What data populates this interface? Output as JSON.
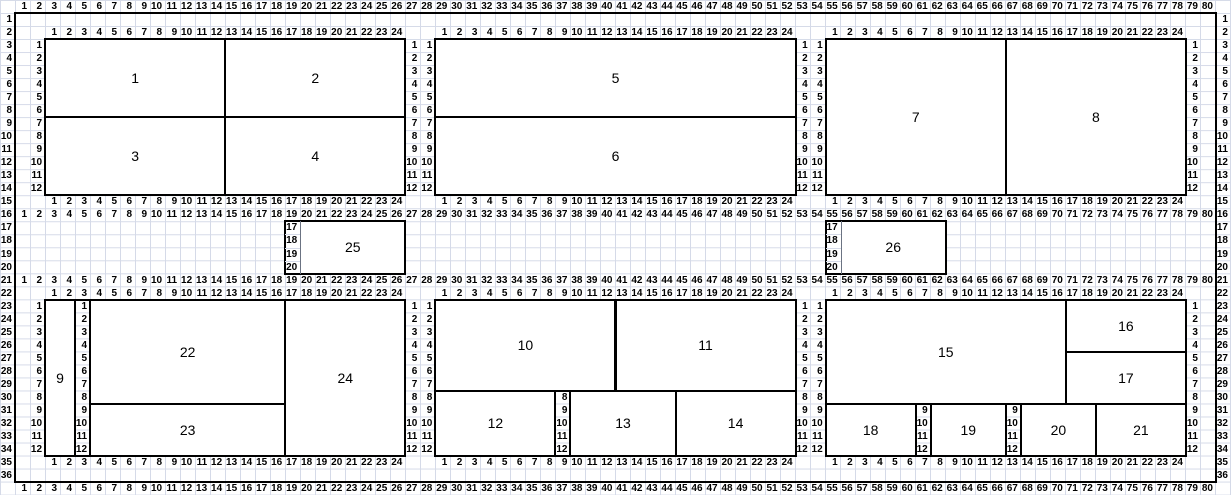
{
  "sheet": {
    "colors": {
      "background": "#ffffff",
      "gridline": "#d5dae8",
      "border": "#000000",
      "text": "#000000"
    },
    "outer_column_numbers": [
      1,
      2,
      3,
      4,
      5,
      6,
      7,
      8,
      9,
      10,
      11,
      12,
      13,
      14,
      15,
      16,
      17,
      18,
      19,
      20,
      21,
      22,
      23,
      24,
      25,
      26,
      27,
      28,
      29,
      30,
      31,
      32,
      33,
      34,
      35,
      36,
      37,
      38,
      39,
      40,
      41,
      42,
      43,
      44,
      45,
      46,
      47,
      48,
      49,
      50,
      51,
      52,
      53,
      54,
      55,
      56,
      57,
      58,
      59,
      60,
      61,
      62,
      63,
      64,
      65,
      66,
      67,
      68,
      69,
      70,
      71,
      72,
      73,
      74,
      75,
      76,
      77,
      78,
      79,
      80
    ],
    "row_numbers": [
      1,
      2,
      3,
      4,
      5,
      6,
      7,
      8,
      9,
      10,
      11,
      12,
      13,
      14,
      15,
      16,
      17,
      18,
      19,
      20,
      21,
      22,
      23,
      24,
      25,
      26,
      27,
      28,
      29,
      30,
      31,
      32,
      33,
      34,
      35,
      36
    ],
    "inner_column_numbers": [
      1,
      2,
      3,
      4,
      5,
      6,
      7,
      8,
      9,
      10,
      11,
      12,
      13,
      14,
      15,
      16,
      17,
      18,
      19,
      20,
      21,
      22,
      23,
      24
    ],
    "inner_row_numbers": [
      1,
      2,
      3,
      4,
      5,
      6,
      7,
      8,
      9,
      10,
      11,
      12
    ],
    "outer_header_rows": [
      0,
      16,
      21,
      37
    ],
    "row_number_columns": [
      0,
      81
    ],
    "inner_col_header_rows": [
      2,
      15,
      22,
      35
    ],
    "inner_col_header_start_cols": [
      3,
      29,
      55
    ],
    "inner_row_header_cols": [
      2,
      27,
      28,
      53,
      54,
      79
    ],
    "inner_row_header_start_rows": [
      3,
      23
    ],
    "range_border": {
      "c1": 1,
      "r1": 1,
      "c2": 80,
      "r2": 36
    },
    "label_columns": [
      {
        "col": 19,
        "row": 17,
        "values": [
          17,
          18,
          19,
          20
        ],
        "inside_box": true
      },
      {
        "col": 55,
        "row": 17,
        "values": [
          17,
          18,
          19,
          20
        ],
        "inside_box": true
      },
      {
        "col": 5,
        "row": 23,
        "values": [
          1,
          2,
          3,
          4,
          5,
          6,
          7,
          8,
          9,
          10,
          11,
          12
        ],
        "inside_box": false
      },
      {
        "col": 37,
        "row": 30,
        "values": [
          8,
          9,
          10,
          11,
          12
        ],
        "inside_box": false
      },
      {
        "col": 61,
        "row": 31,
        "values": [
          9,
          10,
          11,
          12
        ],
        "inside_box": false
      },
      {
        "col": 67,
        "row": 31,
        "values": [
          9,
          10,
          11,
          12
        ],
        "inside_box": false
      }
    ],
    "boxes": [
      {
        "label": "1",
        "c1": 3,
        "r1": 3,
        "c2": 14,
        "r2": 8
      },
      {
        "label": "2",
        "c1": 15,
        "r1": 3,
        "c2": 26,
        "r2": 8
      },
      {
        "label": "3",
        "c1": 3,
        "r1": 9,
        "c2": 14,
        "r2": 14
      },
      {
        "label": "4",
        "c1": 15,
        "r1": 9,
        "c2": 26,
        "r2": 14
      },
      {
        "label": "5",
        "c1": 29,
        "r1": 3,
        "c2": 52,
        "r2": 8
      },
      {
        "label": "6",
        "c1": 29,
        "r1": 9,
        "c2": 52,
        "r2": 14
      },
      {
        "label": "7",
        "c1": 55,
        "r1": 3,
        "c2": 66,
        "r2": 14
      },
      {
        "label": "8",
        "c1": 67,
        "r1": 3,
        "c2": 78,
        "r2": 14
      },
      {
        "label": "25",
        "c1": 19,
        "r1": 17,
        "c2": 26,
        "r2": 20,
        "label_from_col": 20
      },
      {
        "label": "26",
        "c1": 55,
        "r1": 17,
        "c2": 62,
        "r2": 20,
        "label_from_col": 56
      },
      {
        "label": "9",
        "c1": 3,
        "r1": 23,
        "c2": 4,
        "r2": 34
      },
      {
        "label": "22",
        "c1": 6,
        "r1": 23,
        "c2": 18,
        "r2": 30
      },
      {
        "label": "23",
        "c1": 6,
        "r1": 31,
        "c2": 18,
        "r2": 34
      },
      {
        "label": "24",
        "c1": 19,
        "r1": 23,
        "c2": 26,
        "r2": 34
      },
      {
        "label": "10",
        "c1": 29,
        "r1": 23,
        "c2": 40,
        "r2": 29
      },
      {
        "label": "11",
        "c1": 41,
        "r1": 23,
        "c2": 52,
        "r2": 29
      },
      {
        "label": "12",
        "c1": 29,
        "r1": 30,
        "c2": 36,
        "r2": 34
      },
      {
        "label": "13",
        "c1": 38,
        "r1": 30,
        "c2": 44,
        "r2": 34
      },
      {
        "label": "14",
        "c1": 45,
        "r1": 30,
        "c2": 52,
        "r2": 34
      },
      {
        "label": "15",
        "c1": 55,
        "r1": 23,
        "c2": 70,
        "r2": 30
      },
      {
        "label": "16",
        "c1": 71,
        "r1": 23,
        "c2": 78,
        "r2": 26
      },
      {
        "label": "17",
        "c1": 71,
        "r1": 27,
        "c2": 78,
        "r2": 30
      },
      {
        "label": "18",
        "c1": 55,
        "r1": 31,
        "c2": 60,
        "r2": 34
      },
      {
        "label": "19",
        "c1": 62,
        "r1": 31,
        "c2": 66,
        "r2": 34
      },
      {
        "label": "20",
        "c1": 68,
        "r1": 31,
        "c2": 72,
        "r2": 34
      },
      {
        "label": "21",
        "c1": 73,
        "r1": 31,
        "c2": 78,
        "r2": 34
      }
    ]
  }
}
